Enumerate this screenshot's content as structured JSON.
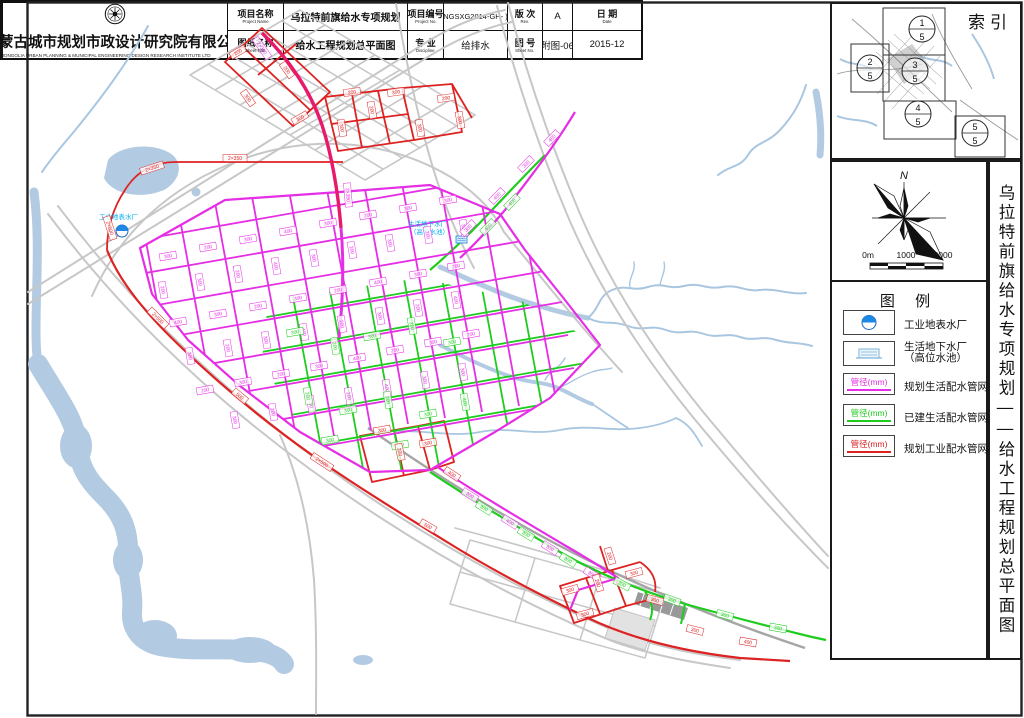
{
  "colors": {
    "planned_domestic": "#E52EE5",
    "existing_domestic": "#1ECC1E",
    "planned_industrial": "#DD2222",
    "trunk_main": "#E8196B",
    "water": "#B3CBE2",
    "stream": "#A9C6E0",
    "road": "#C7C7C7",
    "railway": "#A5A5A5",
    "plant_label": "#00AEEF"
  },
  "index_panel": {
    "title": "索引",
    "sheet_circles": [
      {
        "num": "1",
        "den": "5"
      },
      {
        "num": "2",
        "den": "5"
      },
      {
        "num": "3",
        "den": "5"
      },
      {
        "num": "4",
        "den": "5"
      },
      {
        "num": "5",
        "den": "5"
      }
    ]
  },
  "compass": {
    "north_label": "N"
  },
  "scale_bar": {
    "labels": [
      "0m",
      "1000",
      "2000"
    ]
  },
  "legend": {
    "title": "图  例",
    "items": [
      {
        "label": "工业地表水厂"
      },
      {
        "label": "生活地下水厂",
        "label2": "（高位水池）"
      },
      {
        "symbol_text": "管径(mm)",
        "label": "规划生活配水管网"
      },
      {
        "symbol_text": "管径(mm)",
        "label": "已建生活配水管网"
      },
      {
        "symbol_text": "管径(mm)",
        "label": "规划工业配水管网"
      }
    ]
  },
  "side_title": "乌拉特前旗给水专项规划——给水工程规划总平面图",
  "title_block": {
    "company": "内蒙古城市规划市政设计研究院有限公司",
    "company_en": "INNER MONGOLIA URBAN PLANNING & MUNICIPAL ENGINEERING DESIGN RESEARCH INSTITUTE LTD",
    "row1": {
      "c1_label": "项目名称",
      "c1_en": "Project Name",
      "c2_value": "乌拉特前旗给水专项规划",
      "c3_label": "项目编号",
      "c3_en": "Project No.",
      "c4_value": "NGSXG2014-GH- )",
      "c5_label": "版 次",
      "c5_en": "Rev.",
      "c6_value": "A",
      "c7_label": "日 期",
      "c7_en": "Date"
    },
    "row2": {
      "c1_label": "图纸名称",
      "c1_en": "Sheet Title",
      "c2_value": "给水工程规划总平面图",
      "c3_label": "专 业",
      "c3_en": "Discipline",
      "c4_value": "给排水",
      "c5_label": "图 号",
      "c5_en": "Sheet No.",
      "c6_value": "附图-06",
      "c7_value": "2015-12"
    }
  },
  "map": {
    "plant_labels": {
      "industrial": "工业地表水厂",
      "domestic_line1": "生活地下水厂",
      "domestic_line2": "（高位水池）"
    },
    "pipe_labels": [
      [
        168,
        256,
        -10,
        "300",
        "m"
      ],
      [
        208,
        247,
        -10,
        "200",
        "m"
      ],
      [
        248,
        239,
        -10,
        "300",
        "m"
      ],
      [
        288,
        231,
        -10,
        "400",
        "m"
      ],
      [
        328,
        223,
        -10,
        "300",
        "m"
      ],
      [
        368,
        215,
        -10,
        "200",
        "m"
      ],
      [
        408,
        208,
        -10,
        "300",
        "m"
      ],
      [
        448,
        200,
        -10,
        "300",
        "m"
      ],
      [
        163,
        290,
        80,
        "200",
        "m"
      ],
      [
        200,
        282,
        80,
        "300",
        "m"
      ],
      [
        238,
        274,
        80,
        "200",
        "m"
      ],
      [
        276,
        266,
        80,
        "400",
        "m"
      ],
      [
        314,
        258,
        80,
        "300",
        "m"
      ],
      [
        352,
        250,
        80,
        "200",
        "m"
      ],
      [
        390,
        243,
        80,
        "300",
        "m"
      ],
      [
        428,
        235,
        80,
        "200",
        "m"
      ],
      [
        464,
        228,
        80,
        "300",
        "m"
      ],
      [
        178,
        322,
        -10,
        "400",
        "m"
      ],
      [
        218,
        314,
        -10,
        "300",
        "m"
      ],
      [
        258,
        306,
        -10,
        "200",
        "m"
      ],
      [
        298,
        298,
        -10,
        "300",
        "m"
      ],
      [
        338,
        290,
        -10,
        "200",
        "m"
      ],
      [
        378,
        282,
        -10,
        "400",
        "m"
      ],
      [
        418,
        274,
        -10,
        "300",
        "m"
      ],
      [
        456,
        266,
        -10,
        "200",
        "m"
      ],
      [
        190,
        356,
        80,
        "300",
        "m"
      ],
      [
        228,
        348,
        80,
        "200",
        "m"
      ],
      [
        266,
        340,
        80,
        "300",
        "m"
      ],
      [
        304,
        332,
        80,
        "400",
        "m"
      ],
      [
        342,
        324,
        80,
        "200",
        "m"
      ],
      [
        380,
        316,
        80,
        "300",
        "m"
      ],
      [
        418,
        308,
        80,
        "200",
        "m"
      ],
      [
        456,
        300,
        80,
        "400",
        "m"
      ],
      [
        205,
        390,
        -10,
        "200",
        "m"
      ],
      [
        243,
        382,
        -10,
        "300",
        "m"
      ],
      [
        281,
        374,
        -10,
        "200",
        "m"
      ],
      [
        319,
        366,
        -10,
        "300",
        "m"
      ],
      [
        357,
        358,
        -10,
        "400",
        "m"
      ],
      [
        395,
        350,
        -10,
        "200",
        "m"
      ],
      [
        433,
        342,
        -10,
        "300",
        "m"
      ],
      [
        471,
        334,
        -10,
        "200",
        "m"
      ],
      [
        235,
        420,
        80,
        "300",
        "m"
      ],
      [
        273,
        412,
        80,
        "200",
        "m"
      ],
      [
        311,
        404,
        80,
        "300",
        "m"
      ],
      [
        349,
        396,
        80,
        "200",
        "m"
      ],
      [
        387,
        388,
        80,
        "400",
        "m"
      ],
      [
        425,
        380,
        80,
        "300",
        "m"
      ],
      [
        463,
        372,
        80,
        "300",
        "m"
      ],
      [
        468,
        228,
        -46,
        "300",
        "m"
      ],
      [
        497,
        196,
        -46,
        "400",
        "m"
      ],
      [
        526,
        164,
        -46,
        "300",
        "m"
      ],
      [
        552,
        138,
        -46,
        "400",
        "m"
      ],
      [
        470,
        495,
        32,
        "300",
        "m"
      ],
      [
        510,
        522,
        32,
        "400",
        "m"
      ],
      [
        550,
        548,
        32,
        "300",
        "m"
      ],
      [
        592,
        574,
        32,
        "300",
        "m"
      ],
      [
        262,
        48,
        55,
        "2×350",
        "m"
      ],
      [
        348,
        195,
        85,
        "2×350",
        "m"
      ],
      [
        295,
        332,
        -10,
        "300",
        "g"
      ],
      [
        335,
        346,
        80,
        "200",
        "g"
      ],
      [
        372,
        336,
        -10,
        "300",
        "g"
      ],
      [
        412,
        326,
        80,
        "200",
        "g"
      ],
      [
        452,
        342,
        -10,
        "300",
        "g"
      ],
      [
        308,
        396,
        80,
        "200",
        "g"
      ],
      [
        348,
        410,
        -10,
        "300",
        "g"
      ],
      [
        388,
        400,
        80,
        "200",
        "g"
      ],
      [
        428,
        414,
        -10,
        "300",
        "g"
      ],
      [
        465,
        402,
        80,
        "400",
        "g"
      ],
      [
        330,
        440,
        -10,
        "300",
        "g"
      ],
      [
        400,
        445,
        -10,
        "200",
        "g"
      ],
      [
        488,
        227,
        -46,
        "400",
        "g"
      ],
      [
        512,
        202,
        -46,
        "400",
        "g"
      ],
      [
        484,
        508,
        32,
        "300",
        "g"
      ],
      [
        526,
        534,
        32,
        "300",
        "g"
      ],
      [
        568,
        560,
        32,
        "300",
        "g"
      ],
      [
        622,
        584,
        28,
        "300",
        "g"
      ],
      [
        672,
        600,
        20,
        "300",
        "g"
      ],
      [
        725,
        615,
        15,
        "300",
        "g"
      ],
      [
        778,
        628,
        10,
        "300",
        "g"
      ],
      [
        238,
        52,
        -30,
        "200",
        "r"
      ],
      [
        248,
        98,
        55,
        "300",
        "r"
      ],
      [
        287,
        70,
        55,
        "200",
        "r"
      ],
      [
        300,
        118,
        -30,
        "300",
        "r"
      ],
      [
        352,
        92,
        -8,
        "200",
        "r"
      ],
      [
        342,
        128,
        80,
        "300",
        "r"
      ],
      [
        372,
        110,
        80,
        "200",
        "r"
      ],
      [
        396,
        92,
        -8,
        "300",
        "r"
      ],
      [
        420,
        128,
        80,
        "300",
        "r"
      ],
      [
        446,
        98,
        -8,
        "200",
        "r"
      ],
      [
        460,
        120,
        80,
        "300",
        "r"
      ],
      [
        235,
        158,
        0,
        "2×350",
        "r"
      ],
      [
        152,
        168,
        -18,
        "2×350",
        "r"
      ],
      [
        110,
        228,
        72,
        "2×500",
        "r"
      ],
      [
        158,
        318,
        45,
        "2×500",
        "r"
      ],
      [
        240,
        396,
        40,
        "500",
        "r"
      ],
      [
        322,
        462,
        33,
        "2×500",
        "r"
      ],
      [
        428,
        526,
        30,
        "500",
        "r"
      ],
      [
        382,
        430,
        -10,
        "300",
        "r"
      ],
      [
        400,
        452,
        78,
        "200",
        "r"
      ],
      [
        428,
        443,
        -10,
        "300",
        "r"
      ],
      [
        452,
        474,
        33,
        "400",
        "r"
      ],
      [
        570,
        590,
        -15,
        "300",
        "r"
      ],
      [
        598,
        583,
        72,
        "200",
        "r"
      ],
      [
        585,
        614,
        -15,
        "300",
        "r"
      ],
      [
        634,
        573,
        -15,
        "300",
        "r"
      ],
      [
        655,
        600,
        15,
        "300",
        "r"
      ],
      [
        610,
        556,
        72,
        "200",
        "r"
      ],
      [
        695,
        630,
        14,
        "300",
        "r"
      ],
      [
        748,
        642,
        10,
        "400",
        "r"
      ]
    ]
  }
}
